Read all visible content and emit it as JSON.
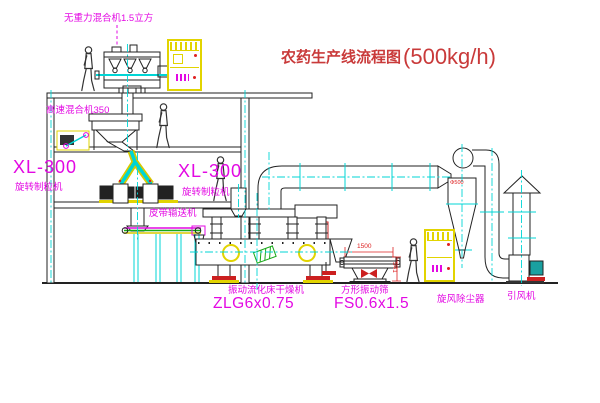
{
  "title": {
    "text": "农药生产线流程图",
    "capacity": "(500kg/h)"
  },
  "equipment_labels": {
    "gravity_free_mixer": "无重力混合机1.5立方",
    "high_speed_mixer": "高速混合机350",
    "granulator_left": {
      "model": "XL-300",
      "name": "旋转制粒机"
    },
    "granulator_mid": {
      "model": "XL-300",
      "name": "旋转制粒机"
    },
    "belt_conveyor": "皮带输送机",
    "fluid_bed_dryer": {
      "name": "振动流化床干燥机",
      "model": "ZLG6x0.75"
    },
    "vibrating_sieve": {
      "name": "方形振动筛",
      "model": "FS0.6x1.5"
    },
    "cyclone": "旋风除尘器",
    "fan": "引风机"
  },
  "dimensions": {
    "sieve_length": "1500",
    "sieve_height": "541",
    "cyclone_diameter": "Φ500"
  },
  "colors": {
    "label_magenta": "#e308e3",
    "title_red": "#c93a3a",
    "dimension_red": "#dd2222",
    "centerline_cyan": "#00d5d5",
    "cabinet_yellow": "#e2d400",
    "line_black": "#222222",
    "status_green": "#18a818"
  }
}
